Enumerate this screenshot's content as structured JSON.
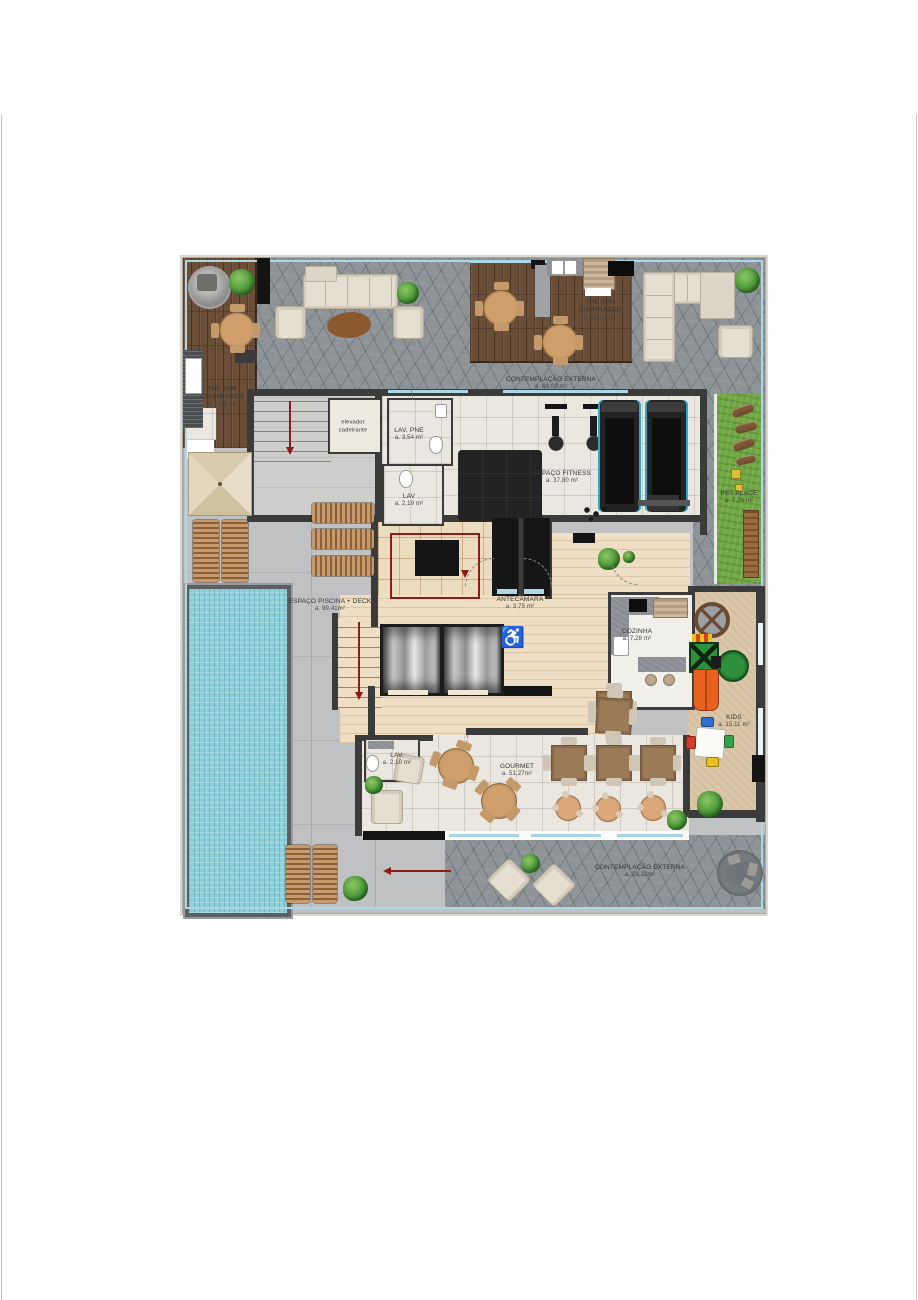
{
  "plan": {
    "rooms": [
      {
        "name": "THE SUN CHURRASCO",
        "area": "a. 7,56 m²"
      },
      {
        "name": "THE SUN CHURRASCO",
        "area": "a. 16,57 m²"
      },
      {
        "name": "CONTEMPLAÇÃO EXTERNA",
        "area": "a. 68,02 m²"
      },
      {
        "name": "LAV. PNE",
        "area": "a. 3,54 m²"
      },
      {
        "name": "LAV",
        "area": "a. 2,19 m²"
      },
      {
        "name": "ESPAÇO FITNESS",
        "area": "a. 37,80 m²"
      },
      {
        "name": "PET PLACE",
        "area": "a. 7,26 m²"
      },
      {
        "name": "ANTECÂMARA",
        "area": "a. 3,75 m²"
      },
      {
        "name": "COZINHA",
        "area": "a. 7,28 m²"
      },
      {
        "name": "ESPAÇO PISCINA + DECK",
        "area": "a. 99,41m²"
      },
      {
        "name": "KIDS",
        "area": "a. 15,11 m²"
      },
      {
        "name": "LAV.",
        "area": "a. 2,10 m²"
      },
      {
        "name": "GOURMET",
        "area": "a. 51,27m²"
      },
      {
        "name": "CONTEMPLAÇÃO EXTERNA",
        "area": "a. 28,32m²"
      }
    ],
    "annotations": {
      "wheelchair_lift": "elevador cadeirante",
      "wheelchair_icon": "♿"
    },
    "colors": {
      "stone": "#8e9398",
      "concrete": "#c0c1c3",
      "deck_wood": "#6b4e37",
      "interior_tile": "#eae7e0",
      "hall_wood": "#eedec3",
      "pool_water": "#8ccfd9",
      "grass": "#6fa742",
      "kids_floor": "#dac7a9",
      "wall": "#3b3b3b",
      "accent_red": "#8e1b1b",
      "glass": "#aed7e6"
    }
  }
}
